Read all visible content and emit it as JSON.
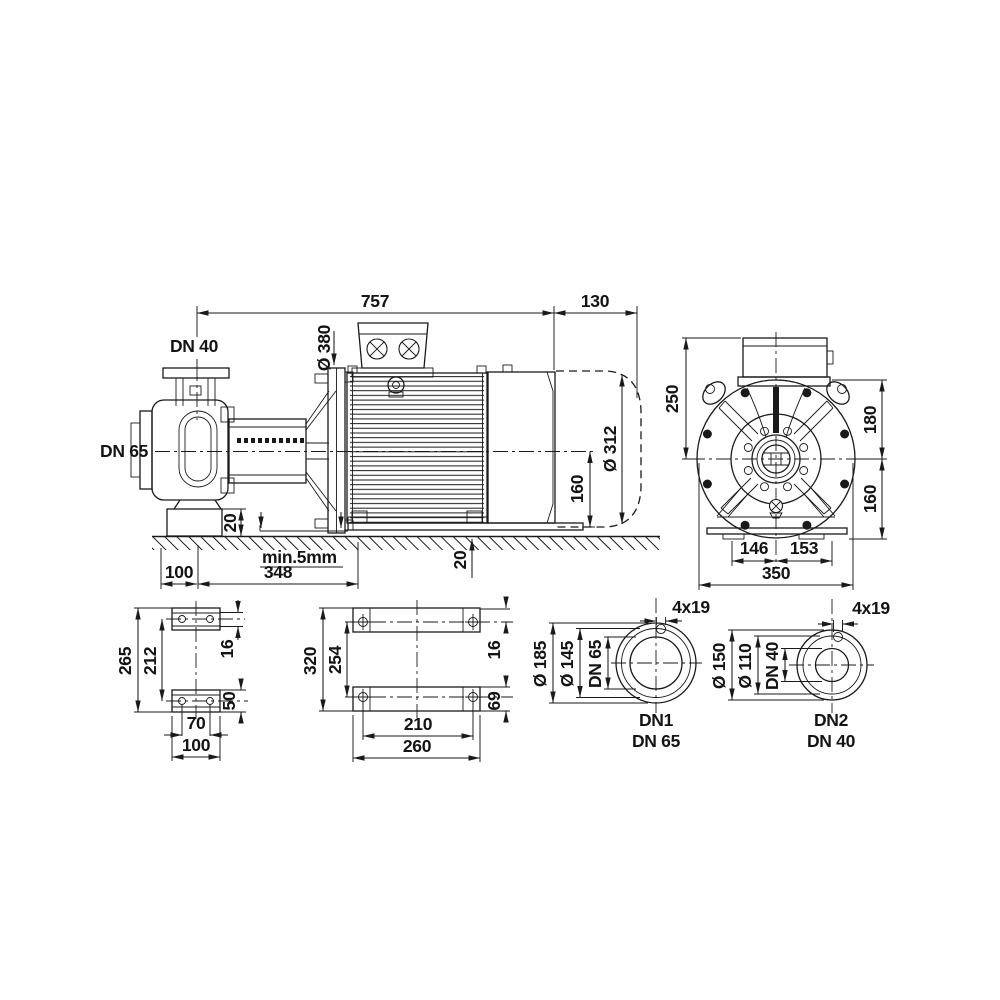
{
  "side": {
    "len": "757",
    "fan": "130",
    "dn40": "DN 40",
    "dn65": "DN 65",
    "dia380": "Ø 380",
    "dia312": "Ø 312",
    "h160": "160",
    "block20": "20",
    "off100": "100",
    "span348": "348",
    "grout": "min.5mm",
    "foot20": "20"
  },
  "front": {
    "h250": "250",
    "h180": "180",
    "h160": "160",
    "w146": "146",
    "w153": "153",
    "w350": "350"
  },
  "foot": {
    "h265": "265",
    "h212": "212",
    "t16": "16",
    "h50": "50",
    "w70": "70",
    "w100": "100"
  },
  "plate": {
    "h320": "320",
    "h254": "254",
    "t16": "16",
    "h69": "69",
    "w210": "210",
    "w260": "260"
  },
  "flange1": {
    "holes": "4x19",
    "od": "Ø 185",
    "bc": "Ø 145",
    "bore": "DN 65",
    "name": "DN1",
    "size": "DN 65"
  },
  "flange2": {
    "holes": "4x19",
    "od": "Ø 150",
    "bc": "Ø 110",
    "bore": "DN 40",
    "name": "DN2",
    "size": "DN 40"
  }
}
